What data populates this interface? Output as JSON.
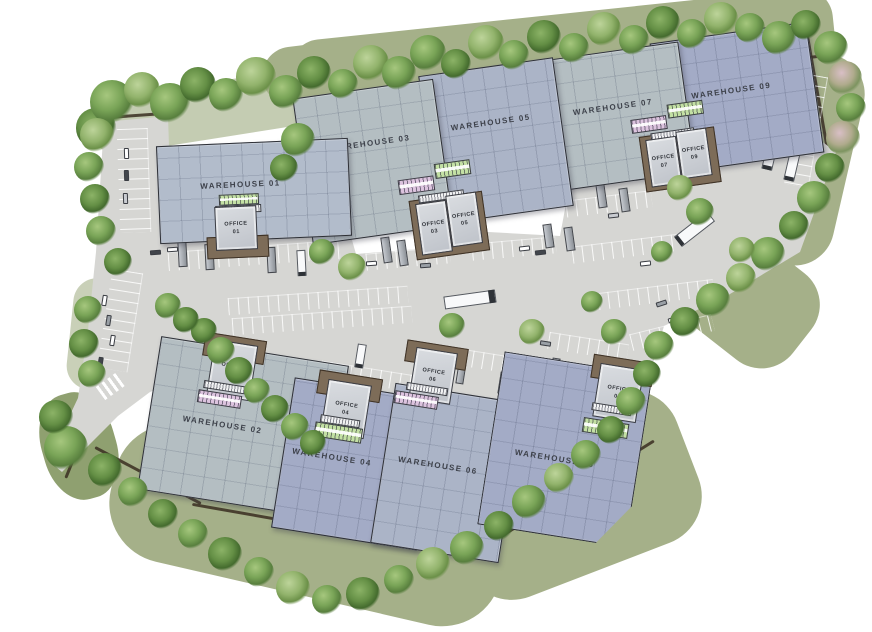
{
  "site_plan": {
    "warehouses": [
      {
        "label": "WAREHOUSE 01"
      },
      {
        "label": "WAREHOUSE 02"
      },
      {
        "label": "WAREHOUSE 03"
      },
      {
        "label": "WAREHOUSE 04"
      },
      {
        "label": "WAREHOUSE 05"
      },
      {
        "label": "WAREHOUSE 06"
      },
      {
        "label": "WAREHOUSE 07"
      },
      {
        "label": "WAREHOUSE 08"
      },
      {
        "label": "WAREHOUSE 09"
      }
    ],
    "offices": [
      {
        "line1": "OFFICE",
        "line2": "01"
      },
      {
        "line1": "OFFICE",
        "line2": "02"
      },
      {
        "line1": "OFFICE",
        "line2": "03"
      },
      {
        "line1": "OFFICE",
        "line2": "04"
      },
      {
        "line1": "OFFICE",
        "line2": "05"
      },
      {
        "line1": "OFFICE",
        "line2": "06"
      },
      {
        "line1": "OFFICE",
        "line2": "07"
      },
      {
        "line1": "OFFICE",
        "line2": "08"
      },
      {
        "line1": "OFFICE",
        "line2": "09"
      }
    ]
  },
  "colors": {
    "pavement": "#d6d6d3",
    "grass": "#a5b089",
    "grass-dark": "#8fa070",
    "roof-a": "#b4bec2",
    "roof-b": "#abb4c7",
    "roof-c": "#b2bccb",
    "roof-d": "#a3abc6",
    "canopy-green": "#c3e0a4",
    "canopy-pink": "#dcc3de",
    "dock-brown": "#7d6c58",
    "boundary": "#3a2e21",
    "label-ink": "#3d414a"
  }
}
